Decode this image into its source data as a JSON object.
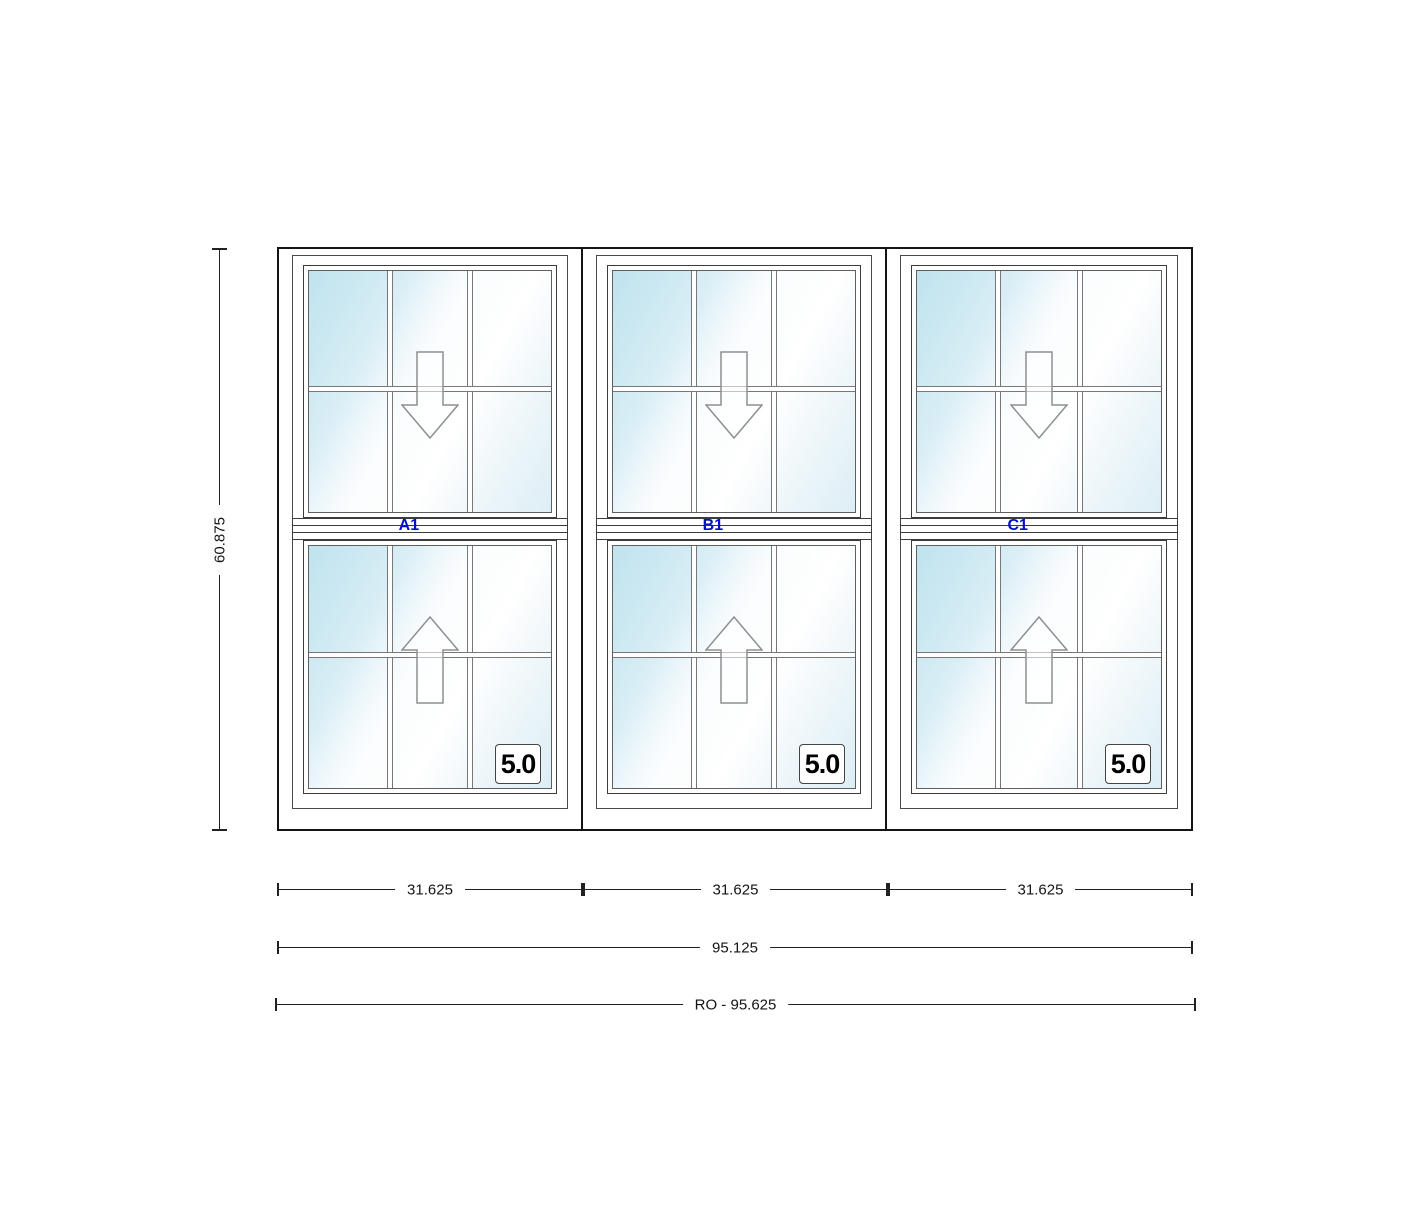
{
  "drawing": {
    "type": "window-elevation",
    "units": [
      {
        "id": "A",
        "label": "A1",
        "glass_rating": "5.0",
        "width": "31.625"
      },
      {
        "id": "B",
        "label": "B1",
        "glass_rating": "5.0",
        "width": "31.625"
      },
      {
        "id": "C",
        "label": "C1",
        "glass_rating": "5.0",
        "width": "31.625"
      }
    ],
    "dimensions": {
      "height": "60.875",
      "overall_width": "95.125",
      "rough_opening": "RO - 95.625"
    },
    "colors": {
      "glass_tint": "#c0e3ee",
      "unit_label_blue": "#0010cc",
      "frame_line": "#3c3c3c",
      "dimension_line": "#222222"
    },
    "icons": {
      "upper_sash": "down-arrow (sash slides down)",
      "lower_sash": "up-arrow (sash slides up)"
    }
  }
}
